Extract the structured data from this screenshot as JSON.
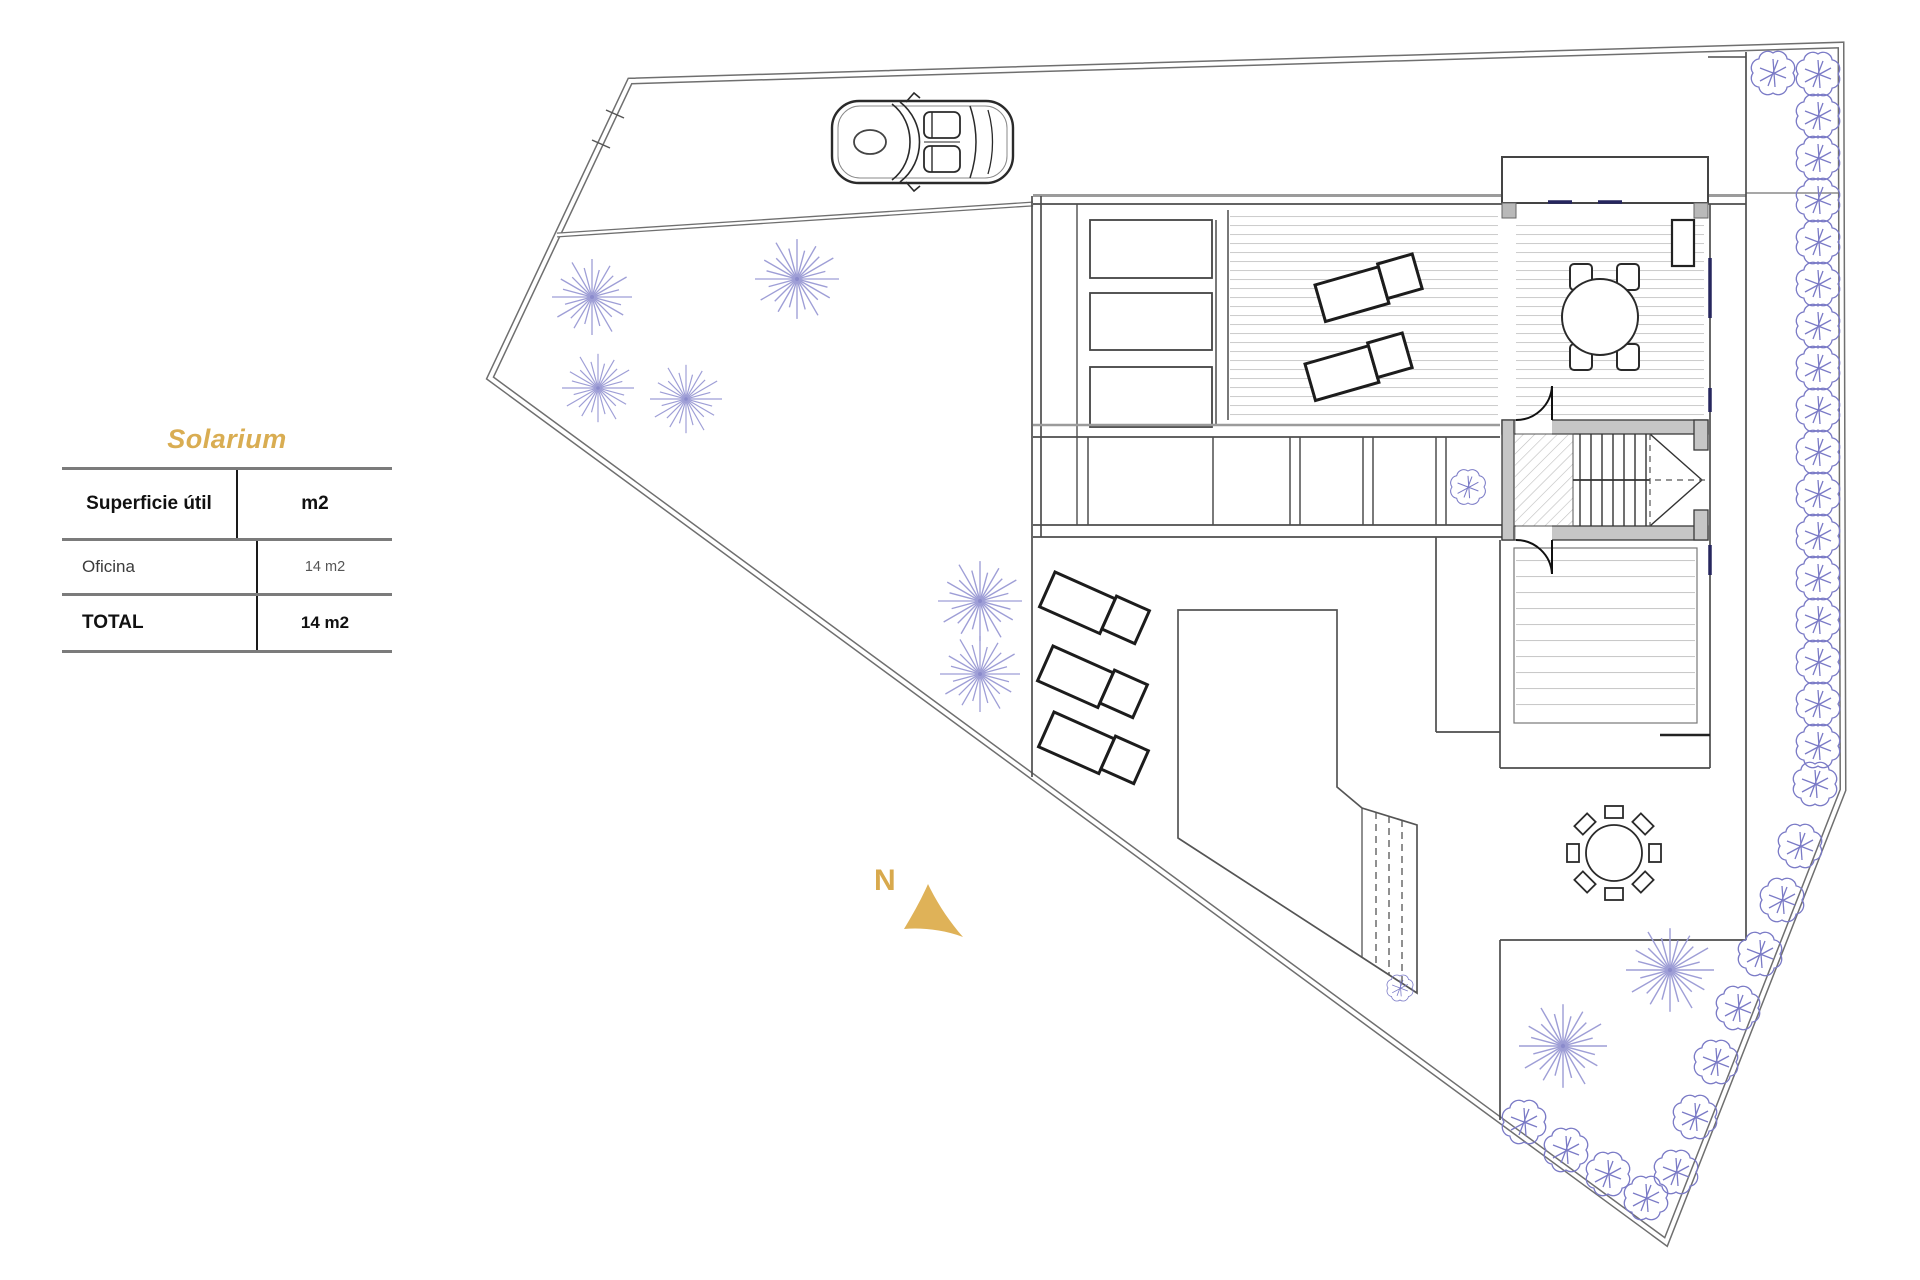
{
  "legend": {
    "title": "Solarium",
    "table": {
      "header": [
        "Superficie útil",
        "m2"
      ],
      "rows": [
        [
          "Oficina",
          "14 m2"
        ]
      ],
      "total": [
        "TOTAL",
        "14 m2"
      ]
    }
  },
  "compass": {
    "label": "N"
  },
  "colors": {
    "accent_gold": "#D9AD52",
    "tree_blue": "#9E9ED6",
    "shrub_blue": "#7A7AC6",
    "window_navy": "#26265E",
    "line_dark": "#4D4D4D",
    "wall_gray": "#C6C6C6"
  }
}
